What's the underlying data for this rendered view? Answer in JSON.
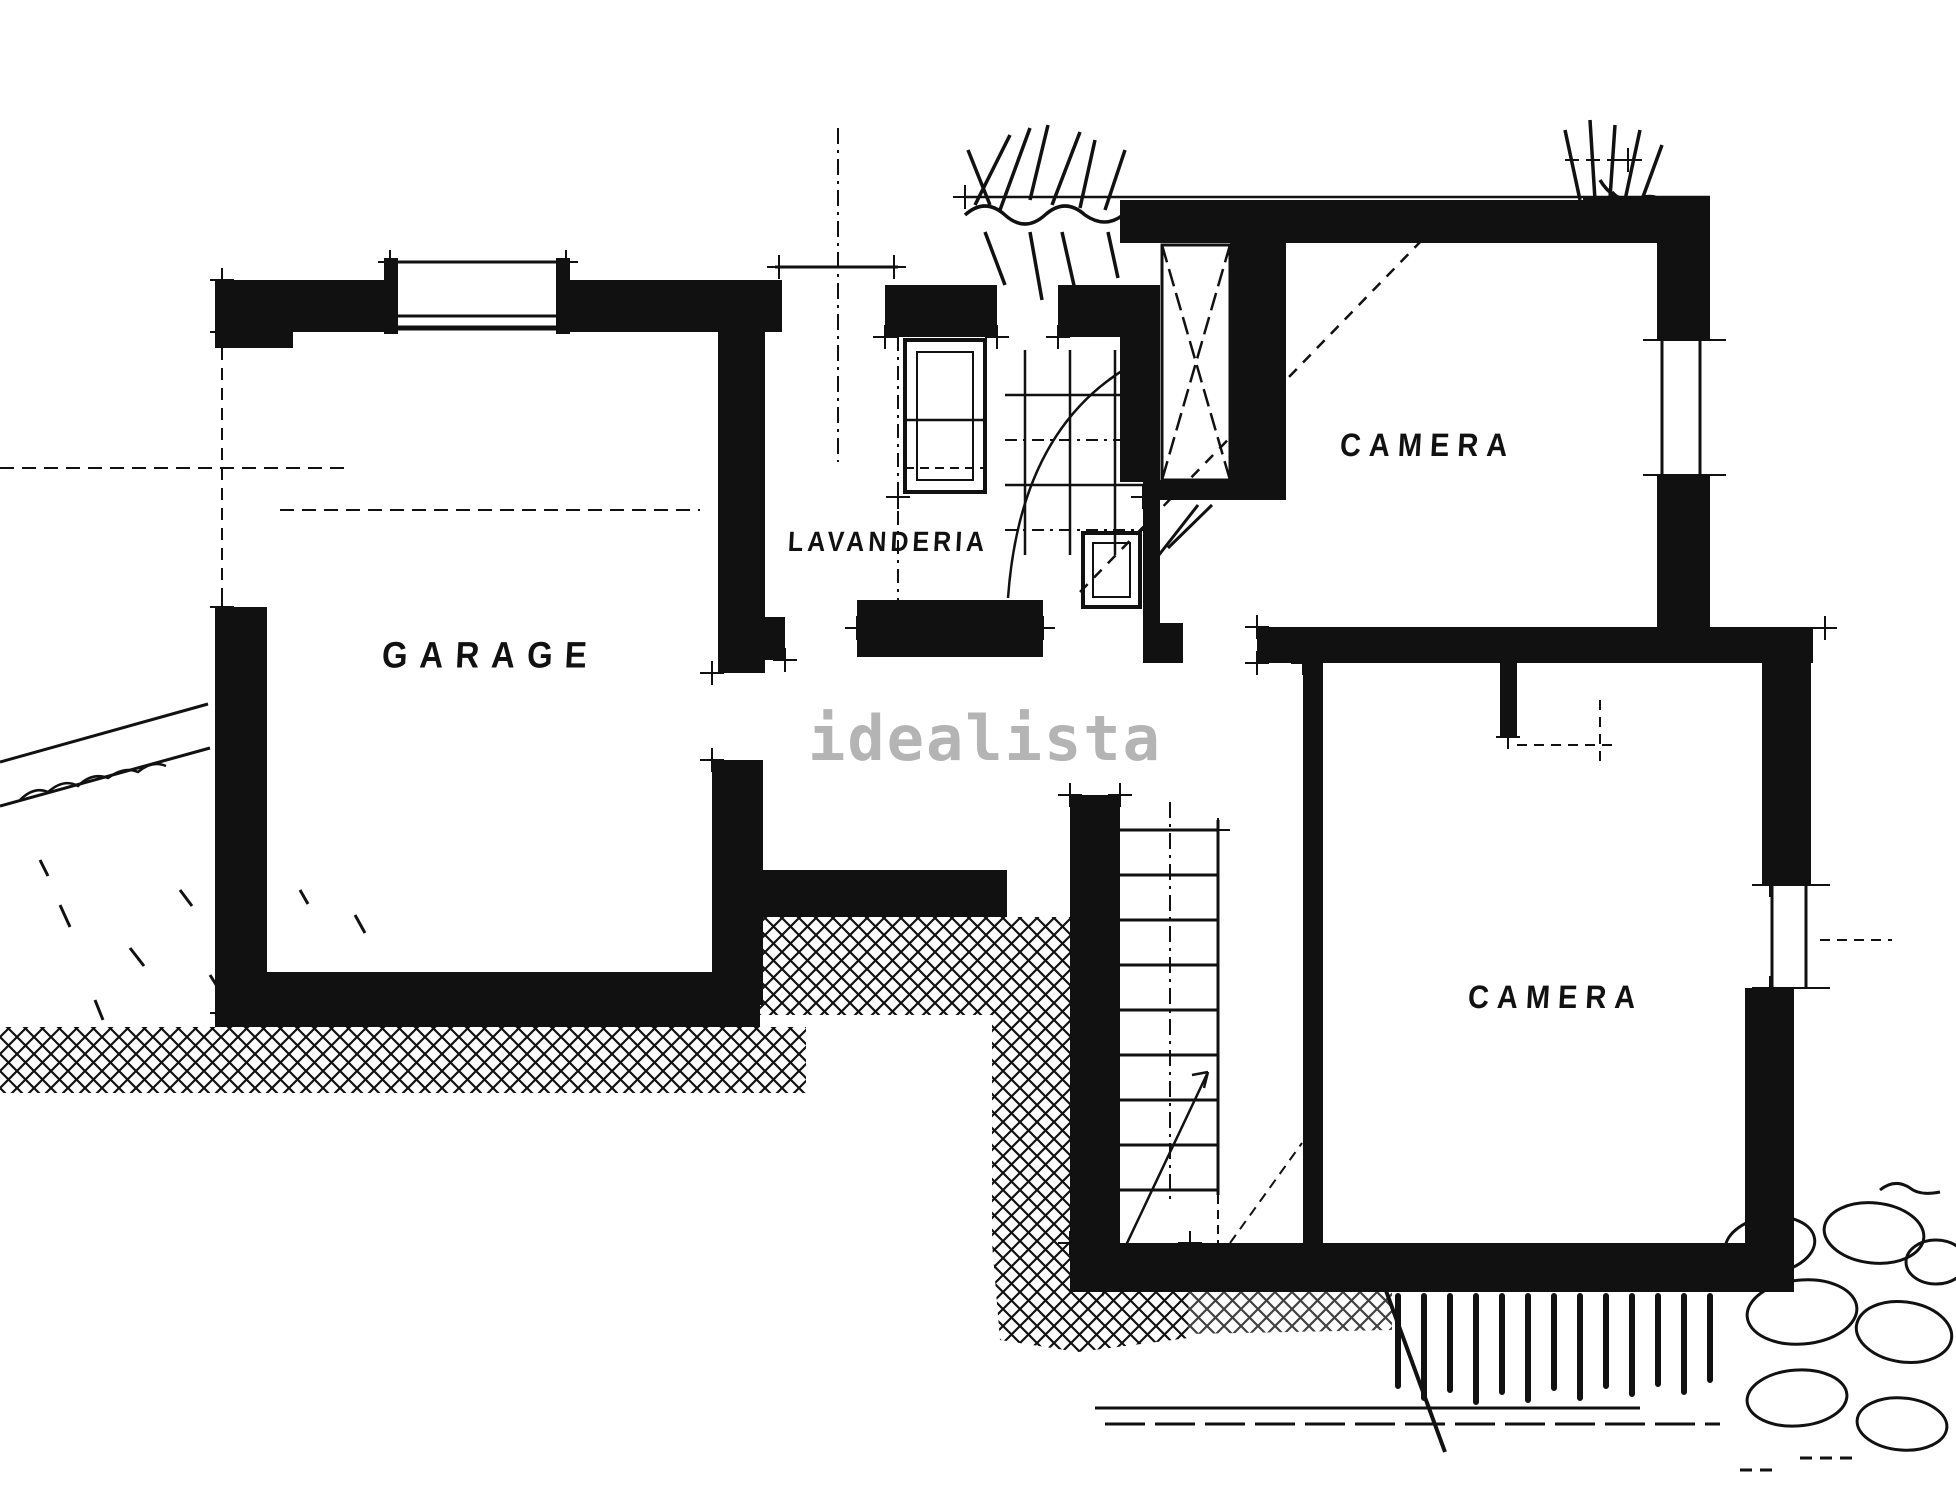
{
  "plan": {
    "type": "floor-plan",
    "rooms": [
      {
        "id": "garage",
        "label": "GARAGE"
      },
      {
        "id": "lavanderia",
        "label": "LAVANDERIA"
      },
      {
        "id": "camera-top",
        "label": "CAMERA"
      },
      {
        "id": "camera-bottom",
        "label": "CAMERA"
      }
    ],
    "watermark": "idealista",
    "colors": {
      "ink": "#111111",
      "paper": "#ffffff",
      "watermark": "#b4b4b4"
    }
  }
}
